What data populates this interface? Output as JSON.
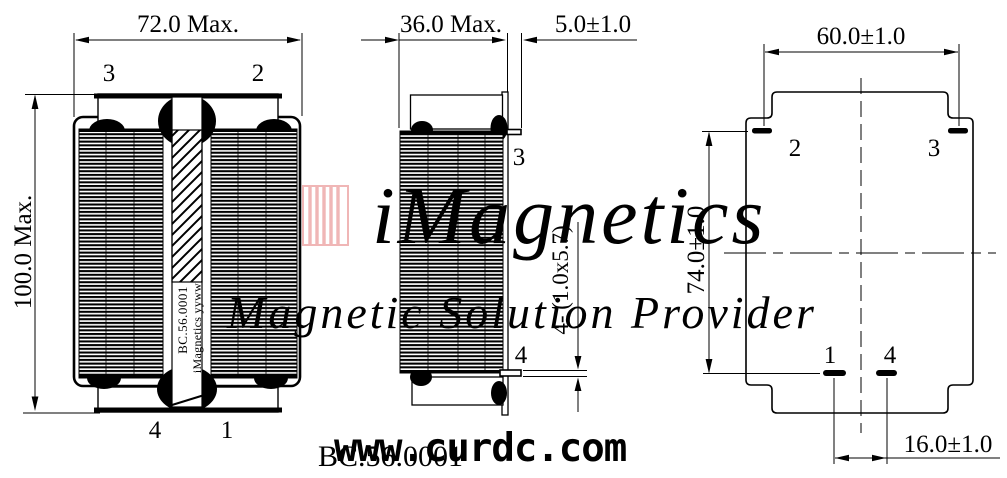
{
  "drawing": {
    "front_view": {
      "dim_width": "72.0 Max.",
      "dim_height": "100.0 Max.",
      "pin_top_left": "3",
      "pin_top_right": "2",
      "pin_bottom_left": "4",
      "pin_bottom_right": "1",
      "marking_line1": "BC.56.0001",
      "marking_line2": "iMagnetics yyww"
    },
    "side_view": {
      "dim_width": "36.0 Max.",
      "dim_pin_length": "5.0±1.0",
      "pin_note": "4- (1.0x5.7)",
      "pin_top": "3",
      "pin_bottom": "4"
    },
    "bottom_view": {
      "dim_row_span": "60.0±1.0",
      "dim_row_pitch": "74.0±1.0",
      "dim_pin_pitch": "16.0±1.0",
      "pin_top_left": "2",
      "pin_top_right": "3",
      "pin_bottom_left": "1",
      "pin_bottom_right": "4"
    },
    "watermark": {
      "brand": "iMagnetics",
      "tagline": "Magnetic Solution Provider",
      "color": "#f0b6b6"
    },
    "footer": {
      "part_number": "BC.56.0001",
      "website": "www.curdc.com"
    },
    "colors": {
      "line": "#000000",
      "background": "#ffffff"
    }
  }
}
